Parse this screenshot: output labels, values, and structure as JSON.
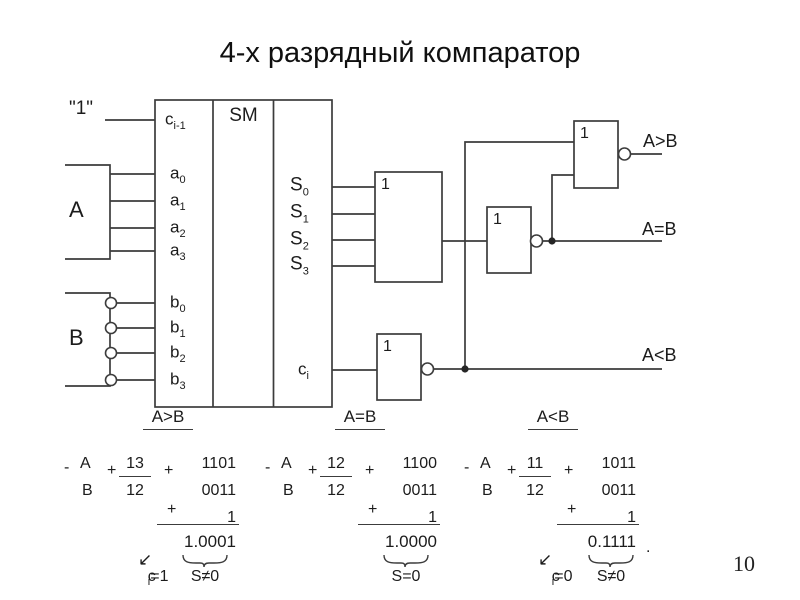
{
  "title": "4-х разрядный компаратор",
  "page_number": "10",
  "carry_in_label": "\"1\"",
  "block_a": "A",
  "block_b": "B",
  "sm": {
    "label": "SM",
    "left_pins": [
      {
        "base": "c",
        "sub": "i-1"
      },
      {
        "base": "a",
        "sub": "0"
      },
      {
        "base": "a",
        "sub": "1"
      },
      {
        "base": "a",
        "sub": "2"
      },
      {
        "base": "a",
        "sub": "3"
      },
      {
        "base": "b",
        "sub": "0"
      },
      {
        "base": "b",
        "sub": "1"
      },
      {
        "base": "b",
        "sub": "2"
      },
      {
        "base": "b",
        "sub": "3"
      }
    ],
    "right_pins": [
      {
        "base": "S",
        "sub": "0"
      },
      {
        "base": "S",
        "sub": "1"
      },
      {
        "base": "S",
        "sub": "2"
      },
      {
        "base": "S",
        "sub": "3"
      },
      {
        "base": "c",
        "sub": "i"
      }
    ]
  },
  "gates": {
    "or": "1",
    "not_eq": "1",
    "not_gt": "1",
    "not_lt": "1"
  },
  "outputs": {
    "gt": "A>B",
    "eq": "A=B",
    "lt": "A<B"
  },
  "sections": {
    "gt": "A>B",
    "eq": "A=B",
    "lt": "A<B"
  },
  "examples": [
    {
      "minus": "-",
      "op_top": "A",
      "op_bottom": "B",
      "plus1": "+",
      "dec_top": "13",
      "dec_bottom": "12",
      "plus2": "+",
      "bin_top": "1101",
      "bin_bottom": "0011",
      "plus3": "+",
      "carry_add": "1",
      "result": "1.0001",
      "arrow": "↙",
      "carry_base": "c",
      "carry_sub": "i",
      "carry_rest": "=1",
      "sum_label": "S≠0"
    },
    {
      "minus": "-",
      "op_top": "A",
      "op_bottom": "B",
      "plus1": "+",
      "dec_top": "12",
      "dec_bottom": "12",
      "plus2": "+",
      "bin_top": "1100",
      "bin_bottom": "0011",
      "plus3": "+",
      "carry_add": "1",
      "result": "1.0000",
      "sum_label": "S=0"
    },
    {
      "minus": "-",
      "op_top": "A",
      "op_bottom": "B",
      "plus1": "+",
      "dec_top": "11",
      "dec_bottom": "12",
      "plus2": "+",
      "bin_top": "1011",
      "bin_bottom": "0011",
      "plus3": "+",
      "carry_add": "1",
      "result": "0.1111",
      "arrow": "↙",
      "carry_base": "c",
      "carry_sub": "i",
      "carry_rest": "=0",
      "sum_label": "S≠0",
      "period": "."
    }
  ]
}
